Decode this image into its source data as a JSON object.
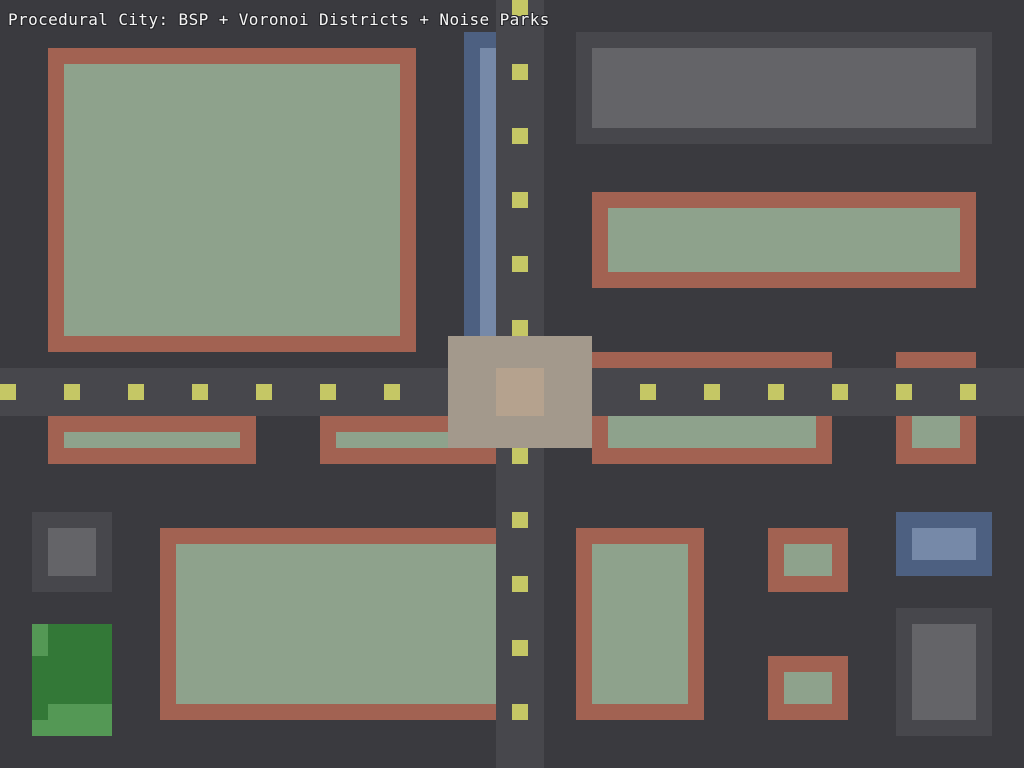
{
  "title": "Procedural City: BSP + Voronoi Districts + Noise Parks",
  "canvas": {
    "width": 1024,
    "height": 768
  },
  "palette": {
    "background": "#3a3a3f",
    "road": "#47474c",
    "dash": "#c5c765",
    "wall": "#a26252",
    "floor": "#8ea28c",
    "gray_wall": "#47474c",
    "gray_floor": "#646468",
    "blue_wall": "#4d6081",
    "blue_floor": "#7689a8",
    "plaza": "#a3998c",
    "plaza_center": "#b5a28e",
    "park": "#337837",
    "park_light": "#549855"
  },
  "scene": {
    "roads": [
      {
        "name": "road-vertical",
        "x": 496,
        "y": 0,
        "w": 48,
        "h": 768,
        "fill": "road"
      },
      {
        "name": "road-horizontal",
        "x": 0,
        "y": 368,
        "w": 1024,
        "h": 48,
        "fill": "road"
      }
    ],
    "lane_dashes": {
      "size": 16,
      "color": "dash",
      "vertical_x": 512,
      "vertical_ys": [
        0,
        64,
        128,
        192,
        256,
        320,
        384,
        448,
        512,
        576,
        640,
        704
      ],
      "horizontal_y": 384,
      "horizontal_xs": [
        0,
        64,
        128,
        192,
        256,
        320,
        384,
        448,
        512,
        576,
        640,
        704,
        768,
        832,
        896,
        960
      ]
    },
    "buildings": [
      {
        "name": "building-residential-nw-wall",
        "x": 48,
        "y": 48,
        "w": 368,
        "h": 304,
        "fill": "wall"
      },
      {
        "name": "building-residential-nw-floor",
        "x": 64,
        "y": 64,
        "w": 336,
        "h": 272,
        "fill": "floor"
      },
      {
        "name": "building-gray-ne-wall",
        "x": 576,
        "y": 32,
        "w": 416,
        "h": 112,
        "fill": "gray_wall"
      },
      {
        "name": "building-gray-ne-floor",
        "x": 592,
        "y": 48,
        "w": 384,
        "h": 80,
        "fill": "gray_floor"
      },
      {
        "name": "building-east-wall",
        "x": 592,
        "y": 192,
        "w": 384,
        "h": 96,
        "fill": "wall"
      },
      {
        "name": "building-east-floor",
        "x": 608,
        "y": 208,
        "w": 352,
        "h": 64,
        "fill": "floor"
      },
      {
        "name": "canal-strip-wall",
        "x": 464,
        "y": 32,
        "w": 32,
        "h": 304,
        "fill": "blue_wall"
      },
      {
        "name": "canal-strip-floor",
        "x": 480,
        "y": 48,
        "w": 16,
        "h": 288,
        "fill": "blue_floor"
      },
      {
        "name": "building-mid-east-top-edge",
        "x": 592,
        "y": 352,
        "w": 240,
        "h": 16,
        "fill": "wall"
      },
      {
        "name": "building-far-east-top-edge",
        "x": 896,
        "y": 352,
        "w": 80,
        "h": 16,
        "fill": "wall"
      },
      {
        "name": "building-roadside-w1-wall",
        "x": 48,
        "y": 416,
        "w": 208,
        "h": 48,
        "fill": "wall"
      },
      {
        "name": "building-roadside-w1-floor",
        "x": 64,
        "y": 432,
        "w": 176,
        "h": 16,
        "fill": "floor"
      },
      {
        "name": "building-roadside-w2-wall",
        "x": 320,
        "y": 416,
        "w": 176,
        "h": 48,
        "fill": "wall"
      },
      {
        "name": "building-roadside-w2-floor",
        "x": 336,
        "y": 432,
        "w": 112,
        "h": 16,
        "fill": "floor"
      },
      {
        "name": "building-roadside-e1-wall",
        "x": 592,
        "y": 416,
        "w": 240,
        "h": 48,
        "fill": "wall"
      },
      {
        "name": "building-roadside-e1-floor",
        "x": 608,
        "y": 416,
        "w": 208,
        "h": 32,
        "fill": "floor"
      },
      {
        "name": "building-roadside-e2-wall",
        "x": 896,
        "y": 416,
        "w": 80,
        "h": 48,
        "fill": "wall"
      },
      {
        "name": "building-roadside-e2-floor",
        "x": 912,
        "y": 416,
        "w": 48,
        "h": 32,
        "fill": "floor"
      },
      {
        "name": "building-gray-sw-wall",
        "x": 32,
        "y": 512,
        "w": 80,
        "h": 80,
        "fill": "gray_wall"
      },
      {
        "name": "building-gray-sw-floor",
        "x": 48,
        "y": 528,
        "w": 48,
        "h": 48,
        "fill": "gray_floor"
      },
      {
        "name": "park-sw",
        "x": 32,
        "y": 624,
        "w": 80,
        "h": 112,
        "fill": "park"
      },
      {
        "name": "park-sw-noise-patch",
        "x": 32,
        "y": 624,
        "w": 16,
        "h": 32,
        "fill": "park_light"
      },
      {
        "name": "park-sw-noise-patch",
        "x": 48,
        "y": 704,
        "w": 64,
        "h": 32,
        "fill": "park_light"
      },
      {
        "name": "park-sw-noise-patch",
        "x": 32,
        "y": 720,
        "w": 16,
        "h": 16,
        "fill": "park_light"
      },
      {
        "name": "building-south-central-wall",
        "x": 160,
        "y": 528,
        "w": 336,
        "h": 192,
        "fill": "wall"
      },
      {
        "name": "building-south-central-floor",
        "x": 176,
        "y": 544,
        "w": 320,
        "h": 160,
        "fill": "floor"
      },
      {
        "name": "building-south-east-wall",
        "x": 576,
        "y": 528,
        "w": 128,
        "h": 192,
        "fill": "wall"
      },
      {
        "name": "building-south-east-floor",
        "x": 592,
        "y": 544,
        "w": 96,
        "h": 160,
        "fill": "floor"
      },
      {
        "name": "building-small-se1-wall",
        "x": 768,
        "y": 528,
        "w": 80,
        "h": 64,
        "fill": "wall"
      },
      {
        "name": "building-small-se1-floor",
        "x": 784,
        "y": 544,
        "w": 48,
        "h": 32,
        "fill": "floor"
      },
      {
        "name": "building-small-se2-wall",
        "x": 768,
        "y": 656,
        "w": 80,
        "h": 64,
        "fill": "wall"
      },
      {
        "name": "building-small-se2-floor",
        "x": 784,
        "y": 672,
        "w": 48,
        "h": 32,
        "fill": "floor"
      },
      {
        "name": "building-blue-se-wall",
        "x": 896,
        "y": 512,
        "w": 96,
        "h": 64,
        "fill": "blue_wall"
      },
      {
        "name": "building-blue-se-floor",
        "x": 912,
        "y": 528,
        "w": 64,
        "h": 32,
        "fill": "blue_floor"
      },
      {
        "name": "building-gray-se-wall",
        "x": 896,
        "y": 608,
        "w": 96,
        "h": 128,
        "fill": "gray_wall"
      },
      {
        "name": "building-gray-se-floor",
        "x": 912,
        "y": 624,
        "w": 64,
        "h": 96,
        "fill": "gray_floor"
      },
      {
        "name": "plaza",
        "x": 448,
        "y": 336,
        "w": 144,
        "h": 112,
        "fill": "plaza"
      },
      {
        "name": "plaza-center",
        "x": 496,
        "y": 368,
        "w": 48,
        "h": 48,
        "fill": "plaza_center"
      }
    ]
  }
}
